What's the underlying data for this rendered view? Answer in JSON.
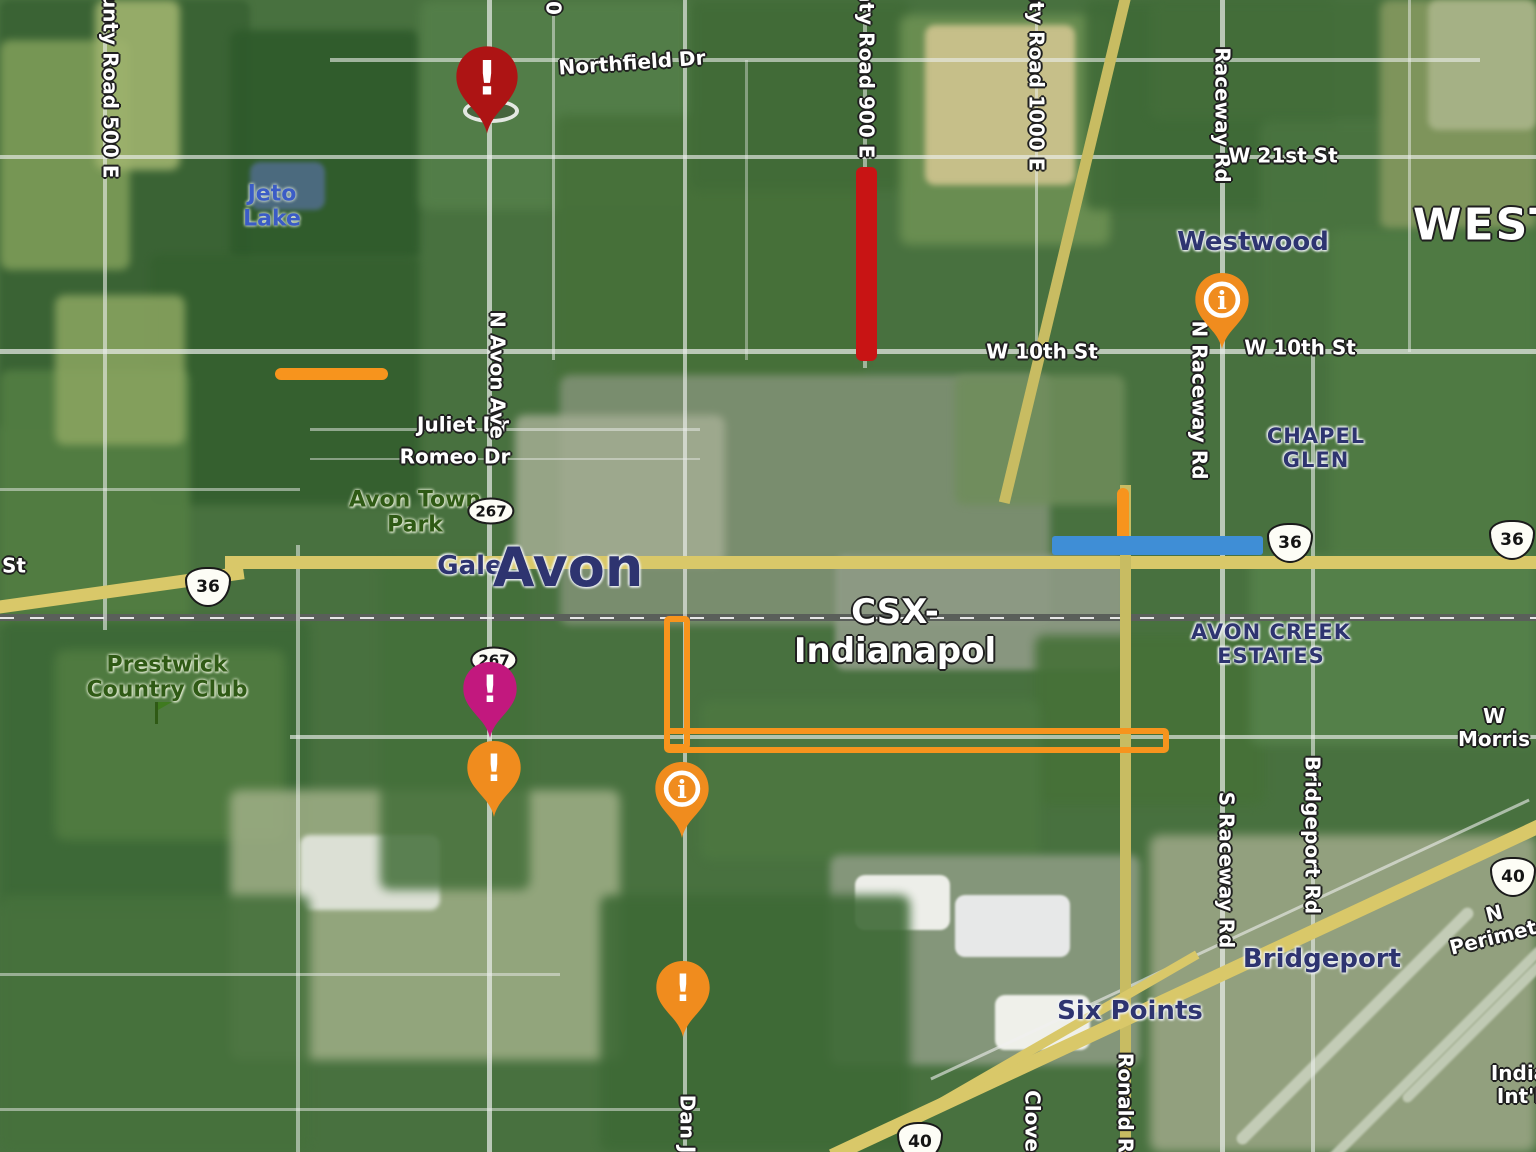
{
  "map_title": "Avon area satellite traffic map",
  "labels": {
    "northfield_dr": "Northfield Dr",
    "county_road_500": "County Road 500 E",
    "county_road_900": "County Road 900 E",
    "county_road_1000": "County Road 1000 E",
    "raceway_rd": "Raceway Rd",
    "w_21st_st": "W 21st St",
    "westwood_large": "WESTWO",
    "westwood": "Westwood",
    "w_10th_st": "W 10th St",
    "n_raceway_rd": "N Raceway Rd",
    "jeto_lake": "Jeto\nLake",
    "juliet_dr": "Juliet Dr",
    "romeo_dr": "Romeo Dr",
    "n_avon_ave": "N Avon Ave",
    "avon_town_park": "Avon Town\nPark",
    "gale": "Gale",
    "avon_large": "Avon",
    "chapel_glen": "CHAPEL\nGLEN",
    "csx_yard": "CSX-\nIndianapol",
    "avon_creek_estates": "AVON CREEK\nESTATES",
    "prestwick": "Prestwick\nCountry Club",
    "w_morris": "W Morris",
    "s_raceway_rd": "S Raceway Rd",
    "bridgeport_rd": "Bridgeport Rd",
    "n_perimeter": "N Perimete",
    "bridgeport": "Bridgeport",
    "six_points": "Six Points",
    "ronald_r": "Ronald R",
    "clover": "Clover",
    "dan_j": "Dan J",
    "indy_intl": "India\nInt'l",
    "st_fragment": "St",
    "top_road_fragment": "0"
  },
  "shields": {
    "sr267": "267",
    "us36": "36",
    "us40": "40"
  },
  "markers": {
    "alert_glyph": "!",
    "info_glyph": "i"
  },
  "colors": {
    "pin_red": "#ad1414",
    "pin_magenta": "#c2187e",
    "pin_orange": "#f08c1e",
    "closure_orange": "#f7941d",
    "closure_red": "#c81414",
    "closure_blue": "#3f8ed6"
  }
}
